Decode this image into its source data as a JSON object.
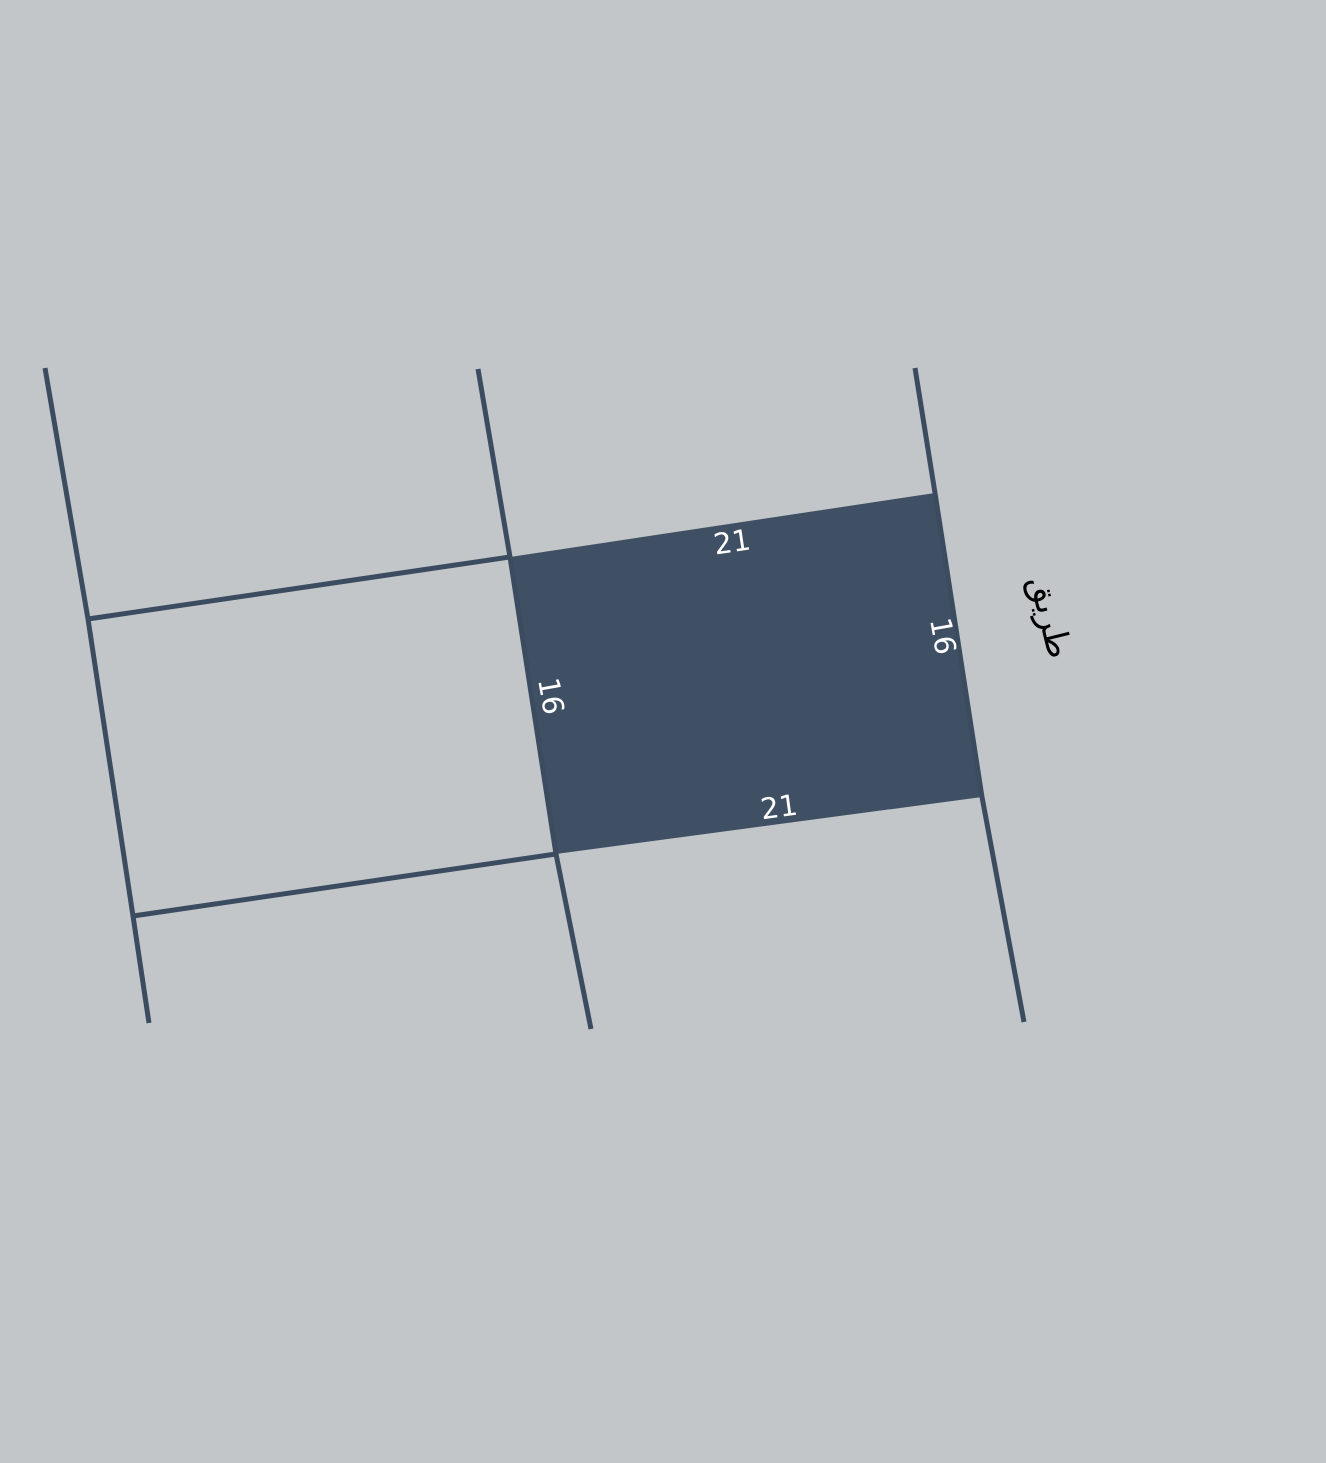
{
  "map": {
    "selected_parcel": {
      "edge_labels": {
        "top": "21",
        "bottom": "21",
        "left": "16",
        "right": "16"
      }
    },
    "road_label": "طريق"
  },
  "colors": {
    "background": "#c2c6c9",
    "boundary_line": "#3c4c60",
    "parcel_fill": "#405064",
    "dimension_label": "#ffffff",
    "road_label": "#000000"
  }
}
